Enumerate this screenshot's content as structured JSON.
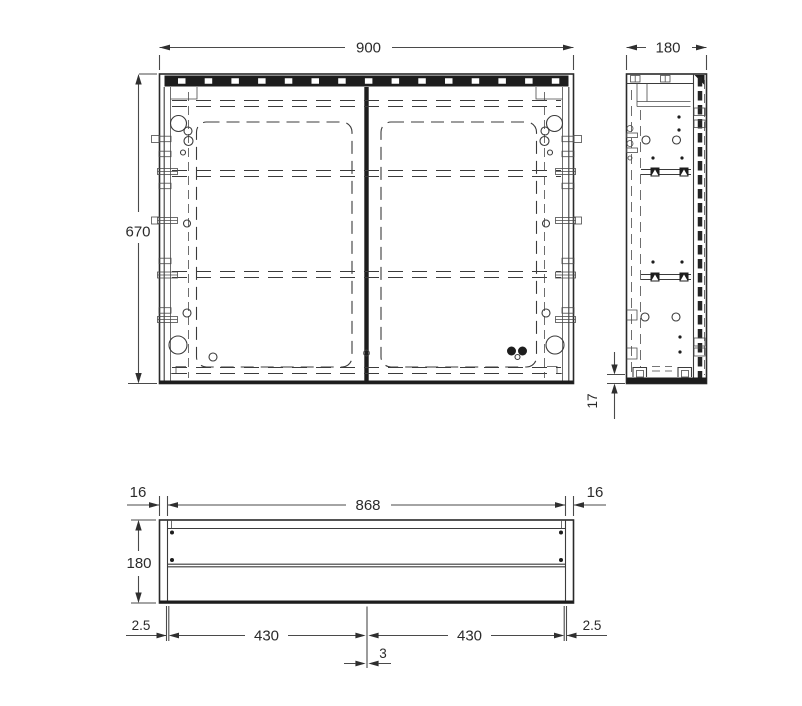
{
  "drawing": {
    "type": "technical-dimension-drawing",
    "subject": "mirror cabinet — front, side and plan views",
    "units": "mm"
  },
  "front_view": {
    "width": "900",
    "height": "670"
  },
  "side_view": {
    "depth": "180",
    "bottom_gap": "17"
  },
  "plan_view": {
    "inner_width": "868",
    "left_panel": "16",
    "right_panel": "16",
    "depth": "180",
    "left_reveal": "2.5",
    "right_reveal": "2.5",
    "left_door": "430",
    "right_door": "430",
    "center_gap": "3"
  },
  "colors": {
    "background": "#ffffff",
    "line": "#3b3b3b",
    "dark_fill": "#1d1d1d",
    "text": "#2b2b2b"
  }
}
